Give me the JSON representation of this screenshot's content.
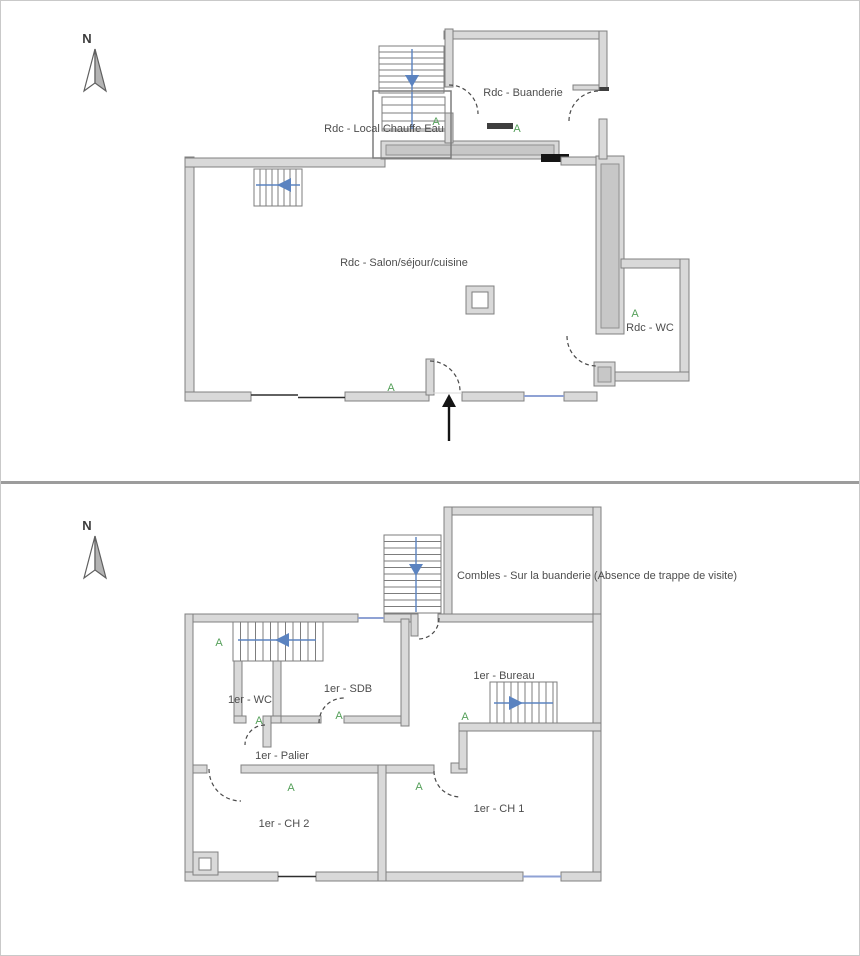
{
  "compass": {
    "label": "N"
  },
  "marker": {
    "label": "A",
    "color": "#55a05a"
  },
  "ground_floor": {
    "rooms": {
      "buanderie": "Rdc - Buanderie",
      "local_chauffe_eau": "Rdc - Local Chauffe Eau",
      "salon_sejour_cuisine": "Rdc - Salon/séjour/cuisine",
      "wc": "Rdc - WC"
    }
  },
  "first_floor": {
    "rooms": {
      "combles": "Combles - Sur la buanderie (Absence de trappe de visite)",
      "wc": "1er - WC",
      "sdb": "1er - SDB",
      "bureau": "1er - Bureau",
      "palier": "1er - Palier",
      "ch2": "1er - CH 2",
      "ch1": "1er - CH 1"
    }
  },
  "colors": {
    "wall_fill": "#d9d9d9",
    "wall_stroke": "#808080",
    "stair_arrow_blue": "#5b83c0",
    "window_blue": "#8fa2d4",
    "door_arc": "#4a4a4a",
    "marker_green": "#55a05a"
  }
}
